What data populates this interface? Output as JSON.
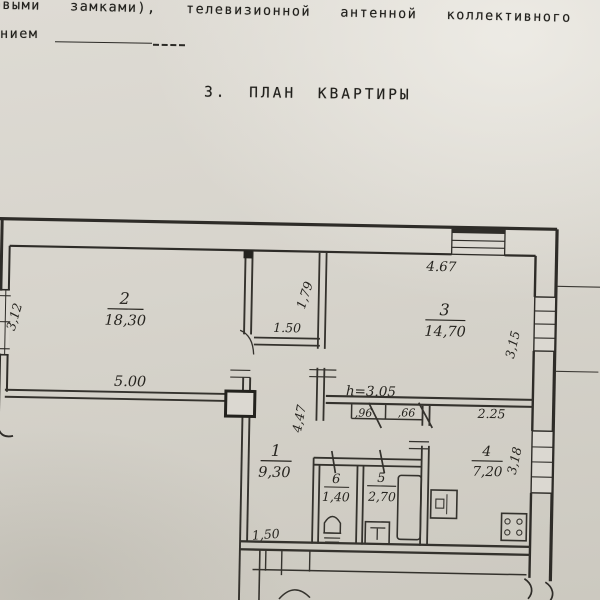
{
  "page": {
    "header_line1": "кодовыми  замками),  телевизионной  антенной  коллективного  пользова",
    "header_line2_prefix": "нием",
    "section_title": "3. ПЛАН КВАРТИРЫ"
  },
  "plan": {
    "rooms": [
      {
        "number": "2",
        "area": "18,30"
      },
      {
        "number": "1",
        "area": "9,30"
      },
      {
        "number": "3",
        "area": "14,70"
      },
      {
        "number": "6",
        "area": "1,40"
      },
      {
        "number": "5",
        "area": "2,70"
      },
      {
        "number": "4",
        "area": "7,20"
      }
    ],
    "dims": {
      "room2_width": "5.00",
      "closet_width": "1.50",
      "closet_depth": "1,79",
      "room3_width": "4.67",
      "hall_length": "4,47",
      "ceiling_height": "h=3.05",
      "kitchen_width": "2.25",
      "left_wall": "3,12",
      "room3_depth": "3,15",
      "kitchen_depth": "3,18",
      "closet_small_1": ",96",
      "closet_small_2": ",66",
      "hall_width": "1,50"
    }
  },
  "colors": {
    "paper": "#d7d4cc",
    "ink": "#2e2c28"
  }
}
